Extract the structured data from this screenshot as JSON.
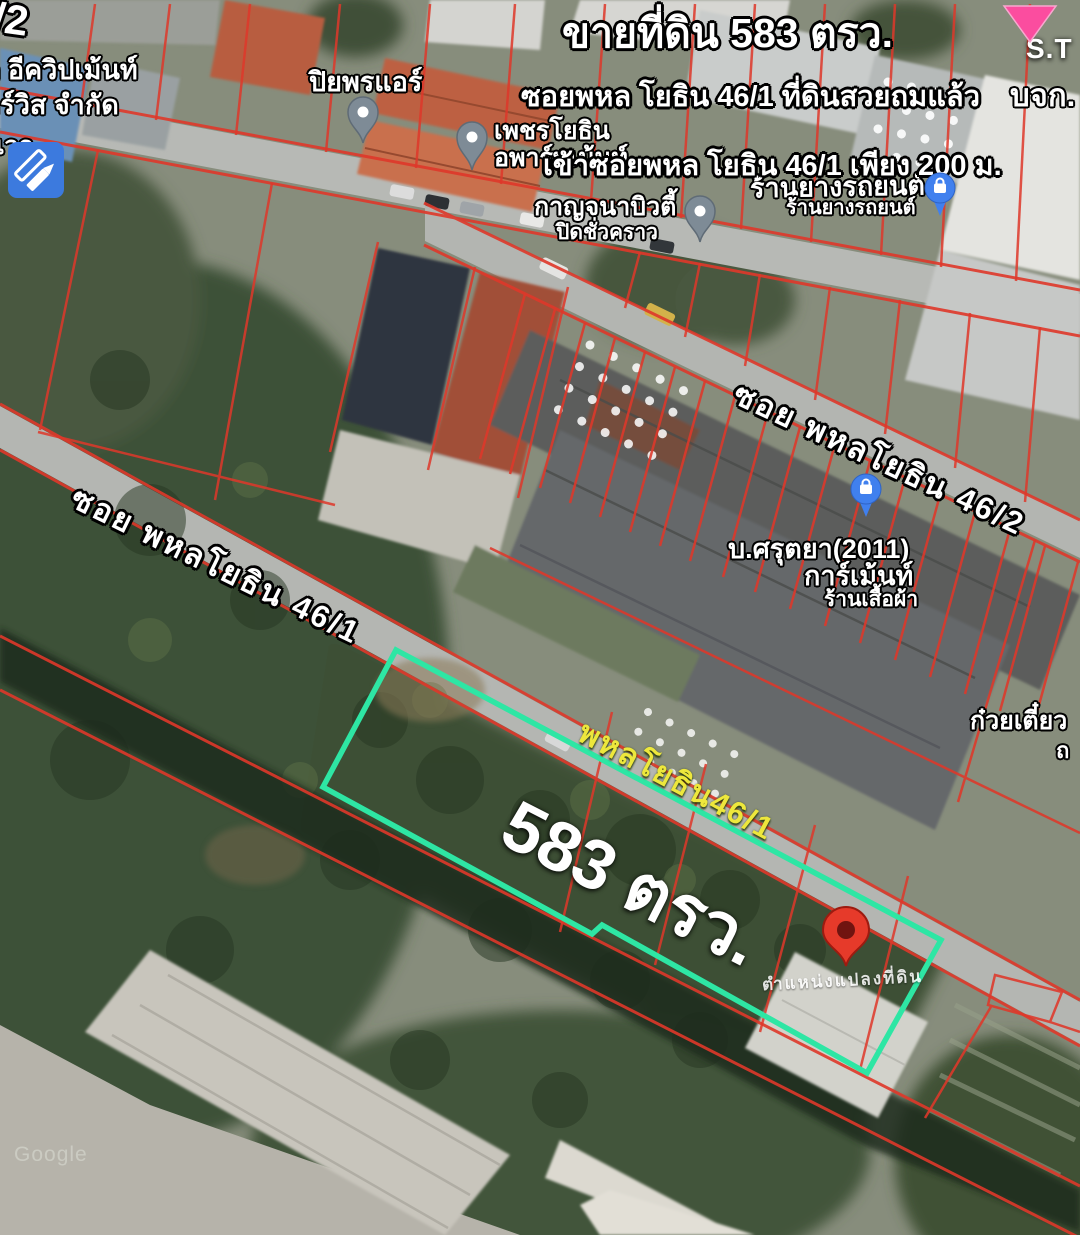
{
  "banner": {
    "title": "ขายที่ดิน 583 ตรว.",
    "line2": "ซอยพหล โยธิน 46/1 ที่ดินสวยถมแล้ว",
    "line3": "เข้าซอยพหล โยธิน 46/1 เพียง 200 ม."
  },
  "roads": {
    "soi_46_2": "ซอย พหลโยธิน 46/2",
    "soi_46_1": "ซอย พหลโยธิน 46/1",
    "yellow_46_1": "พหลโยธิน46/1"
  },
  "parcel": {
    "area_label": "583 ตรว.",
    "deed_label": "ตำแหน่งแปลงที่ดิน"
  },
  "places": {
    "piyaporn_air": "ปิยพรแอร์",
    "phet_line1": "เพชรโยธิน",
    "phet_line2": "อพาร์ทเม้นท์",
    "kanjana_line1": "กาญจนาบิวตี้",
    "kanjana_line2": "ปิดชั่วคราว",
    "tire_large": "ร้านยางรถยนต์",
    "tire_small": "ร้านยางรถยนต์",
    "sarutaya_line1": "บ.ศรุตยา(2011)",
    "sarutaya_line2": "การ์เม้นท์",
    "sarutaya_line3": "ร้านเสื้อผ้า",
    "noodle": "ก๋วยเตี๋ยว",
    "noodle_partial": "ถ",
    "st": "S.T",
    "bjk": "บจก.",
    "equip_line1": "ก อีควิปเม้นท์",
    "equip_line2": "อร์วิส จำกัด",
    "equip_partial": "เวอ",
    "corner_fragment": "6/2"
  },
  "watermark": "Google",
  "colors": {
    "parcel_outline": "#2ee6a4",
    "cadastral_line": "#df382a",
    "yellow_road_label": "#ede73c",
    "red_pin": "#e63a2a",
    "gray_pin": "#7e8b96",
    "blue_pin": "#4080ee",
    "edit_icon_bg": "#3c7ade",
    "triangle_marker": "#fb4d9f"
  },
  "icons": {
    "edit_icon": "pencil-and-ruler",
    "gray_pin": "place-pin",
    "blue_pin": "shopping-bag-pin",
    "red_pin": "location-pin",
    "triangle_marker": "pink-triangle"
  }
}
